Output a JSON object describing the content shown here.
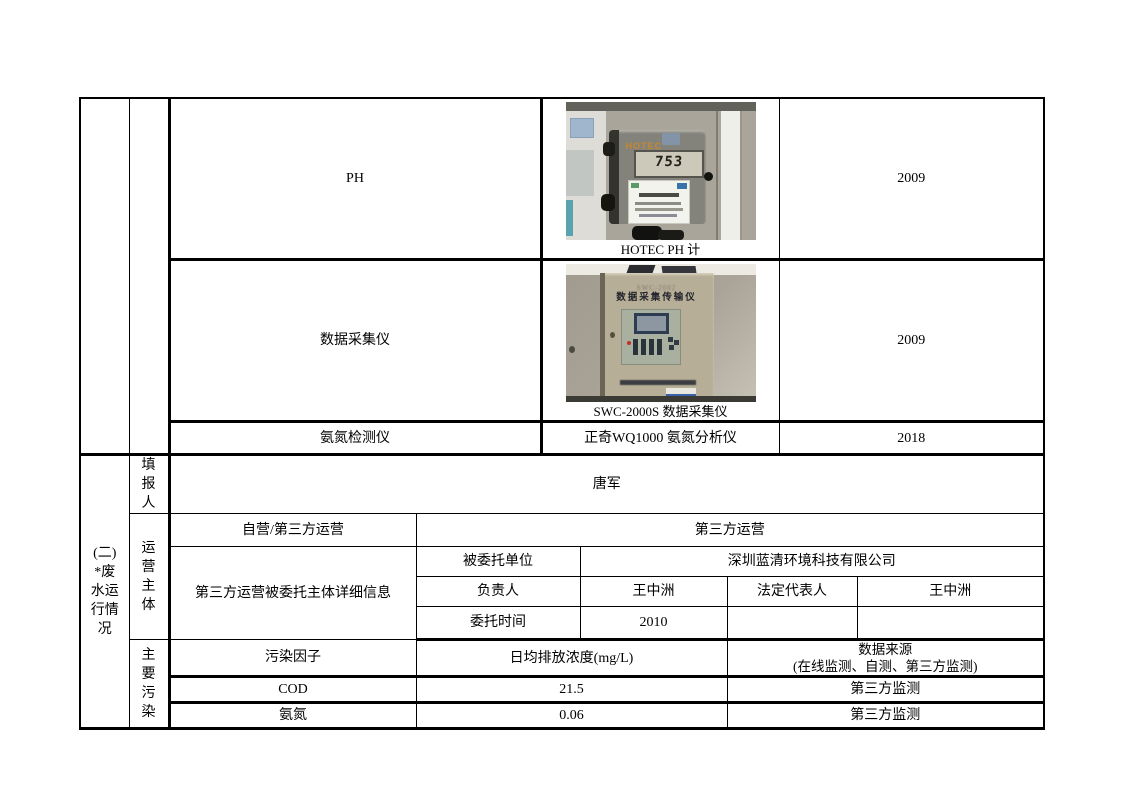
{
  "document": {
    "background": "#ffffff",
    "border_color": "#000000"
  },
  "section_label": "(二)\n*废\n水运\n行情\n况",
  "equipment": {
    "rows": [
      {
        "name": "PH",
        "year": "2009"
      },
      {
        "name": "数据采集仪",
        "year": "2009"
      },
      {
        "name": "氨氮检测仪",
        "model": "正奇WQ1000 氨氮分析仪",
        "year": "2018"
      }
    ]
  },
  "photos": {
    "ph_meter": {
      "caption": "HOTEC PH 计",
      "brand": "HOTEC",
      "lcd_value": "753"
    },
    "data_collector": {
      "caption": "SWC-2000S 数据采集仪",
      "model": "SWC-2002",
      "title": "数据采集传输仪"
    }
  },
  "reporter": {
    "label": "填\n报\n人",
    "value": "唐军"
  },
  "operation": {
    "label": "运\n营\n主\n体",
    "mode_label": "自营/第三方运营",
    "mode_value": "第三方运营",
    "detail_label": "第三方运营被委托主体详细信息",
    "entrusted_unit_label": "被委托单位",
    "entrusted_unit_value": "深圳蓝清环境科技有限公司",
    "manager_label": "负责人",
    "manager_value": "王中洲",
    "legal_rep_label": "法定代表人",
    "legal_rep_value": "王中洲",
    "entrust_time_label": "委托时间",
    "entrust_time_value": "2010"
  },
  "pollution": {
    "label": "主\n要\n污\n染",
    "header": {
      "factor": "污染因子",
      "concentration": "日均排放浓度(mg/L)",
      "source": "数据来源\n(在线监测、自测、第三方监测)"
    },
    "rows": [
      {
        "factor": "COD",
        "concentration": "21.5",
        "source": "第三方监测"
      },
      {
        "factor": "氨氮",
        "concentration": "0.06",
        "source": "第三方监测"
      }
    ]
  }
}
